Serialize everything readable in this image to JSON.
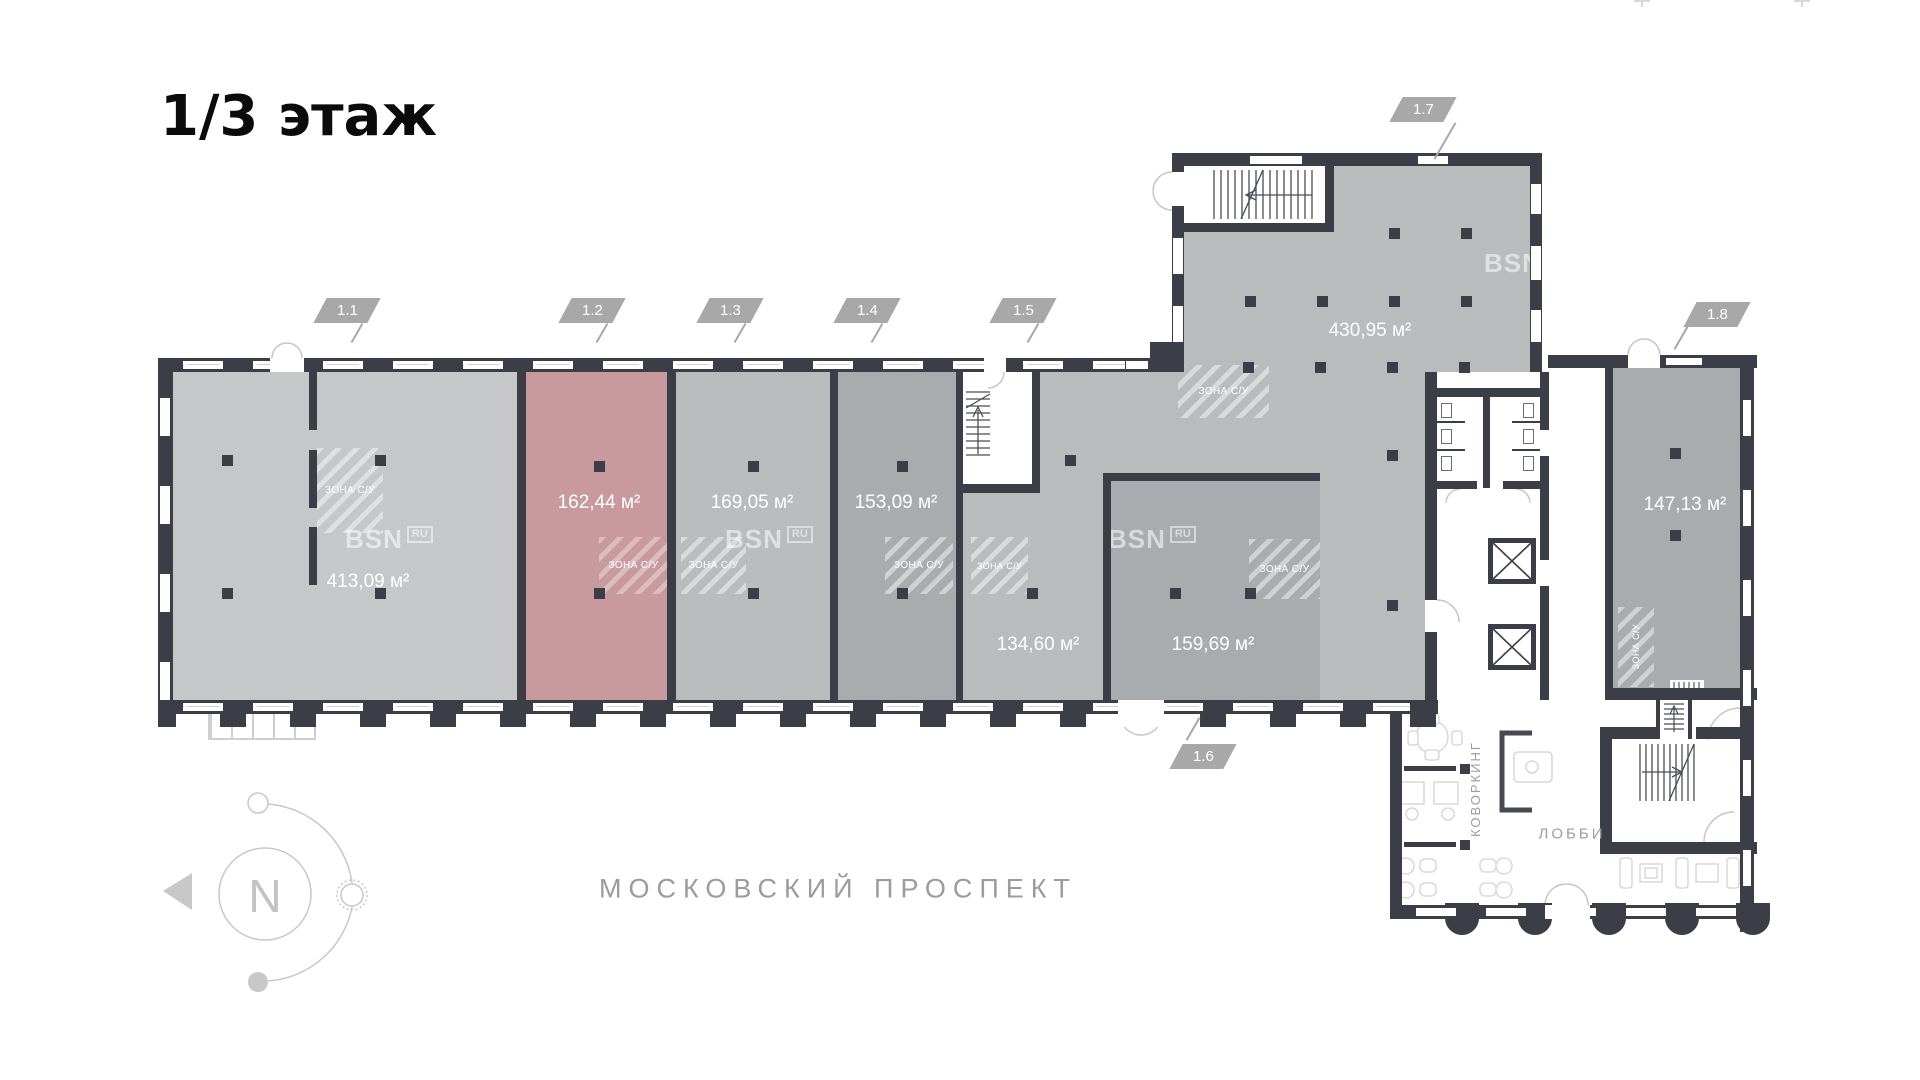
{
  "title": "1/3 этаж",
  "street_label": "МОСКОВСКИЙ ПРОСПЕКТ",
  "compass_letter": "N",
  "watermark": {
    "brand": "BSN",
    "domain": "RU"
  },
  "zone_su_label": "ЗОНА С/У",
  "rooms": {
    "coworking": "КОВОРКИНГ",
    "lobby": "ЛОББИ"
  },
  "units": [
    {
      "tag": "1.1",
      "area": "413,09 м²",
      "highlighted": false
    },
    {
      "tag": "1.2",
      "area": "162,44 м²",
      "highlighted": true
    },
    {
      "tag": "1.3",
      "area": "169,05 м²",
      "highlighted": false
    },
    {
      "tag": "1.4",
      "area": "153,09 м²",
      "highlighted": false
    },
    {
      "tag": "1.5",
      "area": "134,60 м²",
      "highlighted": false
    },
    {
      "tag": "1.6",
      "area": "159,69 м²",
      "highlighted": false
    },
    {
      "tag": "1.7",
      "area": "430,95 м²",
      "highlighted": false
    },
    {
      "tag": "1.8",
      "area": "147,13 м²",
      "highlighted": false
    }
  ],
  "colors": {
    "wall": "#3b3e47",
    "unit-light": "#c5c7c9",
    "unit-mid": "#b9bbbd",
    "unit-dark": "#a9acae",
    "unit-highlight": "#c89a9e",
    "tag-bg": "#a8a8a8",
    "line": "#c6c6c6",
    "muted-text": "#9c9c9c"
  }
}
